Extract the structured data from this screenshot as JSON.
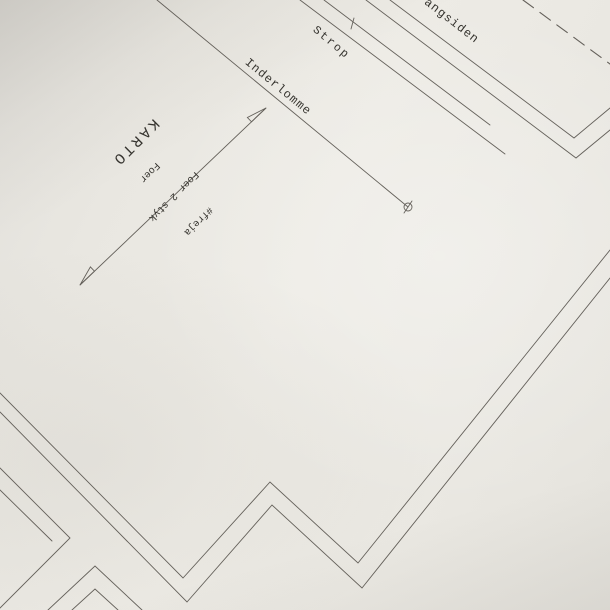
{
  "labels": {
    "vrangsiden": "vrangsiden",
    "strop": "Strop",
    "inderlomme": "Inderlomme",
    "piece_name": "KARTO",
    "grainline": {
      "line1": "#freja",
      "line2": "Foer 2 styk",
      "line3": "Foer"
    }
  },
  "colors": {
    "paper": "#eae8e2",
    "paper_shadow": "#dedcd6",
    "line": "#524e48",
    "text": "#35332e"
  }
}
